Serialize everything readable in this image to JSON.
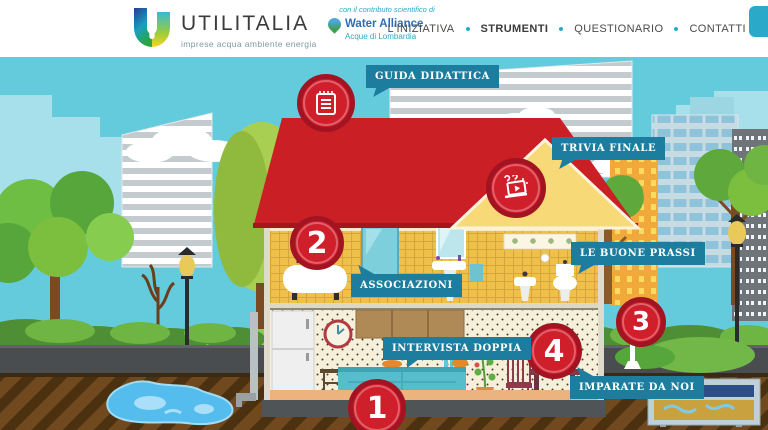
{
  "header": {
    "logo": {
      "name": "UTILITALIA",
      "tagline": "imprese acqua ambiente energia"
    },
    "partner": {
      "intro": "con il contributo scientifico di",
      "name": "Water Alliance",
      "subname": "Acque di Lombardia"
    },
    "nav": [
      {
        "label": "L'INIZIATIVA",
        "active": false
      },
      {
        "label": "STRUMENTI",
        "active": true
      },
      {
        "label": "QUESTIONARIO",
        "active": false
      },
      {
        "label": "CONTATTI",
        "active": false
      }
    ]
  },
  "scene": {
    "hotspot_labels": {
      "guida_didattica": "GUIDA DIDATTICA",
      "trivia_finale": "TRIVIA FINALE",
      "associazioni": "ASSOCIAZIONI",
      "le_buone_prassi": "LE BUONE PRASSI",
      "intervista_doppia": "INTERVISTA DOPPIA",
      "imparate_da_noi": "IMPARATE DA NOI"
    },
    "markers": {
      "kitchen": "1",
      "bathroom": "2",
      "street": "3",
      "dining": "4"
    },
    "icons": [
      "notepad-icon",
      "quiz-laptop-icon"
    ]
  },
  "colors": {
    "accent_teal": "#2aa9c9",
    "bubble_teal": "#1c7d9e",
    "marker_red": "#ce1f2b",
    "sky": "#64cbdd",
    "roof_red": "#c91f25",
    "tile_yellow": "#efc04a"
  }
}
